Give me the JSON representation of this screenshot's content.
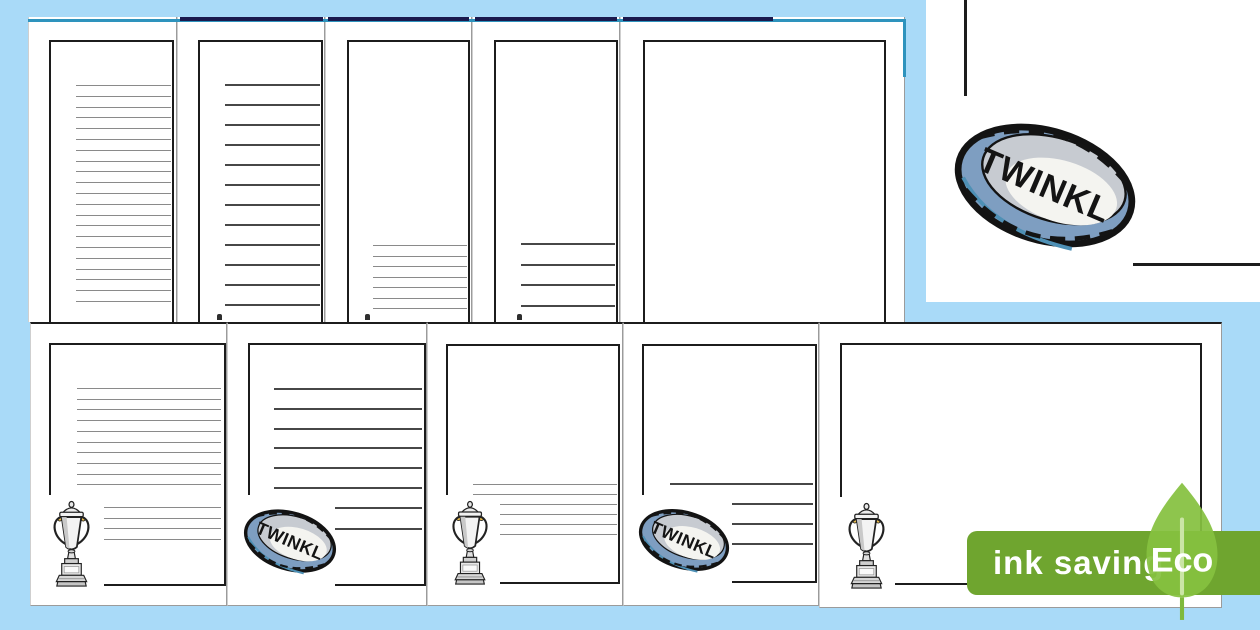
{
  "canvas": {
    "width": 1260,
    "height": 630,
    "background": "#A9DAF8"
  },
  "colors": {
    "page_white": "#FFFFFF",
    "border_black": "#1C1C1C",
    "line_gray": "#8A8A8A",
    "line_dark": "#474747",
    "teal_edge": "#2E93BD",
    "navy_edge": "#1A1A4E",
    "page_seam_light": "#CFCFCF",
    "page_seam_dark": "#9B9B9B",
    "badge_green": "#6FA52F",
    "leaf_green": "#85C140",
    "leaf_vein": "#CBE5A6",
    "leaf_stem": "#7FB93C",
    "ball_band": "#7E9EC1",
    "ball_panel_gray": "#C7CBD1",
    "ball_panel_white": "#F4F4F0",
    "ball_outline": "#131313",
    "ball_accent": "#4E90B5",
    "trophy_gold_accent": "#E6BA4D"
  },
  "badge": {
    "ink_label": "ink saving",
    "eco_label": "Eco"
  },
  "ball": {
    "label": "TWINKL"
  },
  "top_edge": {
    "teal": {
      "x": 28,
      "y": 19,
      "w": 877,
      "h": 3
    },
    "teal_vertical": {
      "x": 903,
      "y": 19,
      "h": 58
    },
    "navy_y": 17,
    "navy_h": 4,
    "navy_segments": [
      {
        "x": 180,
        "w": 143
      },
      {
        "x": 328,
        "w": 141
      },
      {
        "x": 475,
        "w": 142
      },
      {
        "x": 623,
        "w": 150
      }
    ]
  },
  "specks": [
    {
      "x": 217,
      "y": 314
    },
    {
      "x": 365,
      "y": 314
    },
    {
      "x": 517,
      "y": 314
    }
  ],
  "detail_panel": {
    "x": 926,
    "y": 0,
    "w": 334,
    "h": 302,
    "vline": {
      "x": 964,
      "y": 0,
      "w": 3,
      "h": 96
    },
    "hline": {
      "x": 1133,
      "y": 263,
      "w": 127,
      "h": 3
    },
    "ball": {
      "x": 949,
      "y": 112,
      "w": 192,
      "h": 147
    }
  },
  "pages": {
    "top_row": [
      {
        "x": 28,
        "y": 17,
        "w": 149,
        "h": 305,
        "border": {
          "l": 49,
          "t": 40,
          "r": 172
        },
        "lines": [
          {
            "y0": 85,
            "gap": 10.8,
            "n": 21,
            "x1": 76,
            "x2": 171,
            "dark": false
          }
        ]
      },
      {
        "x": 177,
        "y": 17,
        "w": 148,
        "h": 305,
        "border": {
          "l": 198,
          "t": 40,
          "r": 321
        },
        "lines": [
          {
            "y0": 84,
            "gap": 20,
            "n": 12,
            "x1": 225,
            "x2": 320,
            "dark": true
          }
        ]
      },
      {
        "x": 325,
        "y": 17,
        "w": 147,
        "h": 305,
        "border": {
          "l": 347,
          "t": 40,
          "r": 468
        },
        "lines": [
          {
            "y0": 245,
            "gap": 10.5,
            "n": 7,
            "x1": 373,
            "x2": 467,
            "dark": false
          }
        ]
      },
      {
        "x": 472,
        "y": 17,
        "w": 148,
        "h": 305,
        "border": {
          "l": 494,
          "t": 40,
          "r": 616
        },
        "lines": [
          {
            "y0": 243,
            "gap": 20.5,
            "n": 4,
            "x1": 521,
            "x2": 615,
            "dark": true
          }
        ]
      },
      {
        "x": 620,
        "y": 17,
        "w": 285,
        "h": 305,
        "border": {
          "l": 643,
          "t": 40,
          "r": 884
        },
        "lines": []
      }
    ],
    "bottom_row": [
      {
        "x": 30,
        "y": 322,
        "w": 197,
        "h": 284,
        "border": {
          "l": 49,
          "t": 343,
          "r": 224,
          "b": 584,
          "cut": 495,
          "bx": 104
        },
        "lines": [
          {
            "y0": 388,
            "gap": 10.7,
            "n": 10,
            "x1": 77,
            "x2": 221,
            "dark": false
          },
          {
            "y0": 507,
            "gap": 10.7,
            "n": 4,
            "x1": 104,
            "x2": 221,
            "dark": false
          }
        ],
        "icon": {
          "type": "trophy",
          "x": 50,
          "y": 499,
          "w": 43,
          "h": 92
        }
      },
      {
        "x": 227,
        "y": 322,
        "w": 200,
        "h": 284,
        "border": {
          "l": 248,
          "t": 343,
          "r": 424,
          "b": 584,
          "cut": 495,
          "bx": 335
        },
        "lines": [
          {
            "y0": 388,
            "gap": 19.8,
            "n": 6,
            "x1": 274,
            "x2": 422,
            "dark": true
          },
          {
            "y0": 507,
            "gap": 21,
            "n": 2,
            "x1": 335,
            "x2": 422,
            "dark": true
          }
        ],
        "icon": {
          "type": "rugby-ball",
          "x": 241,
          "y": 503,
          "w": 98,
          "h": 76
        }
      },
      {
        "x": 427,
        "y": 322,
        "w": 196,
        "h": 284,
        "border": {
          "l": 446,
          "t": 344,
          "r": 618,
          "b": 582,
          "cut": 495,
          "bx": 500
        },
        "lines": [
          {
            "y0": 484,
            "gap": 10,
            "n": 2,
            "x1": 473,
            "x2": 617,
            "dark": false
          },
          {
            "y0": 504,
            "gap": 10,
            "n": 4,
            "x1": 500,
            "x2": 617,
            "dark": false
          }
        ],
        "icon": {
          "type": "trophy",
          "x": 449,
          "y": 499,
          "w": 42,
          "h": 90
        }
      },
      {
        "x": 623,
        "y": 322,
        "w": 196,
        "h": 284,
        "border": {
          "l": 642,
          "t": 344,
          "r": 815,
          "b": 581,
          "cut": 495,
          "bx": 732
        },
        "lines": [
          {
            "y0": 483,
            "gap": 20,
            "n": 1,
            "x1": 670,
            "x2": 813,
            "dark": true
          },
          {
            "y0": 503,
            "gap": 20,
            "n": 3,
            "x1": 732,
            "x2": 813,
            "dark": true
          }
        ],
        "icon": {
          "type": "rugby-ball",
          "x": 636,
          "y": 502,
          "w": 96,
          "h": 76
        }
      },
      {
        "x": 819,
        "y": 322,
        "w": 403,
        "h": 286,
        "border": {
          "l": 840,
          "t": 343,
          "r": 1200,
          "b": 583,
          "cut": 497,
          "bx": 895
        },
        "lines": [],
        "icon": {
          "type": "trophy",
          "x": 845,
          "y": 501,
          "w": 43,
          "h": 92
        }
      }
    ]
  }
}
